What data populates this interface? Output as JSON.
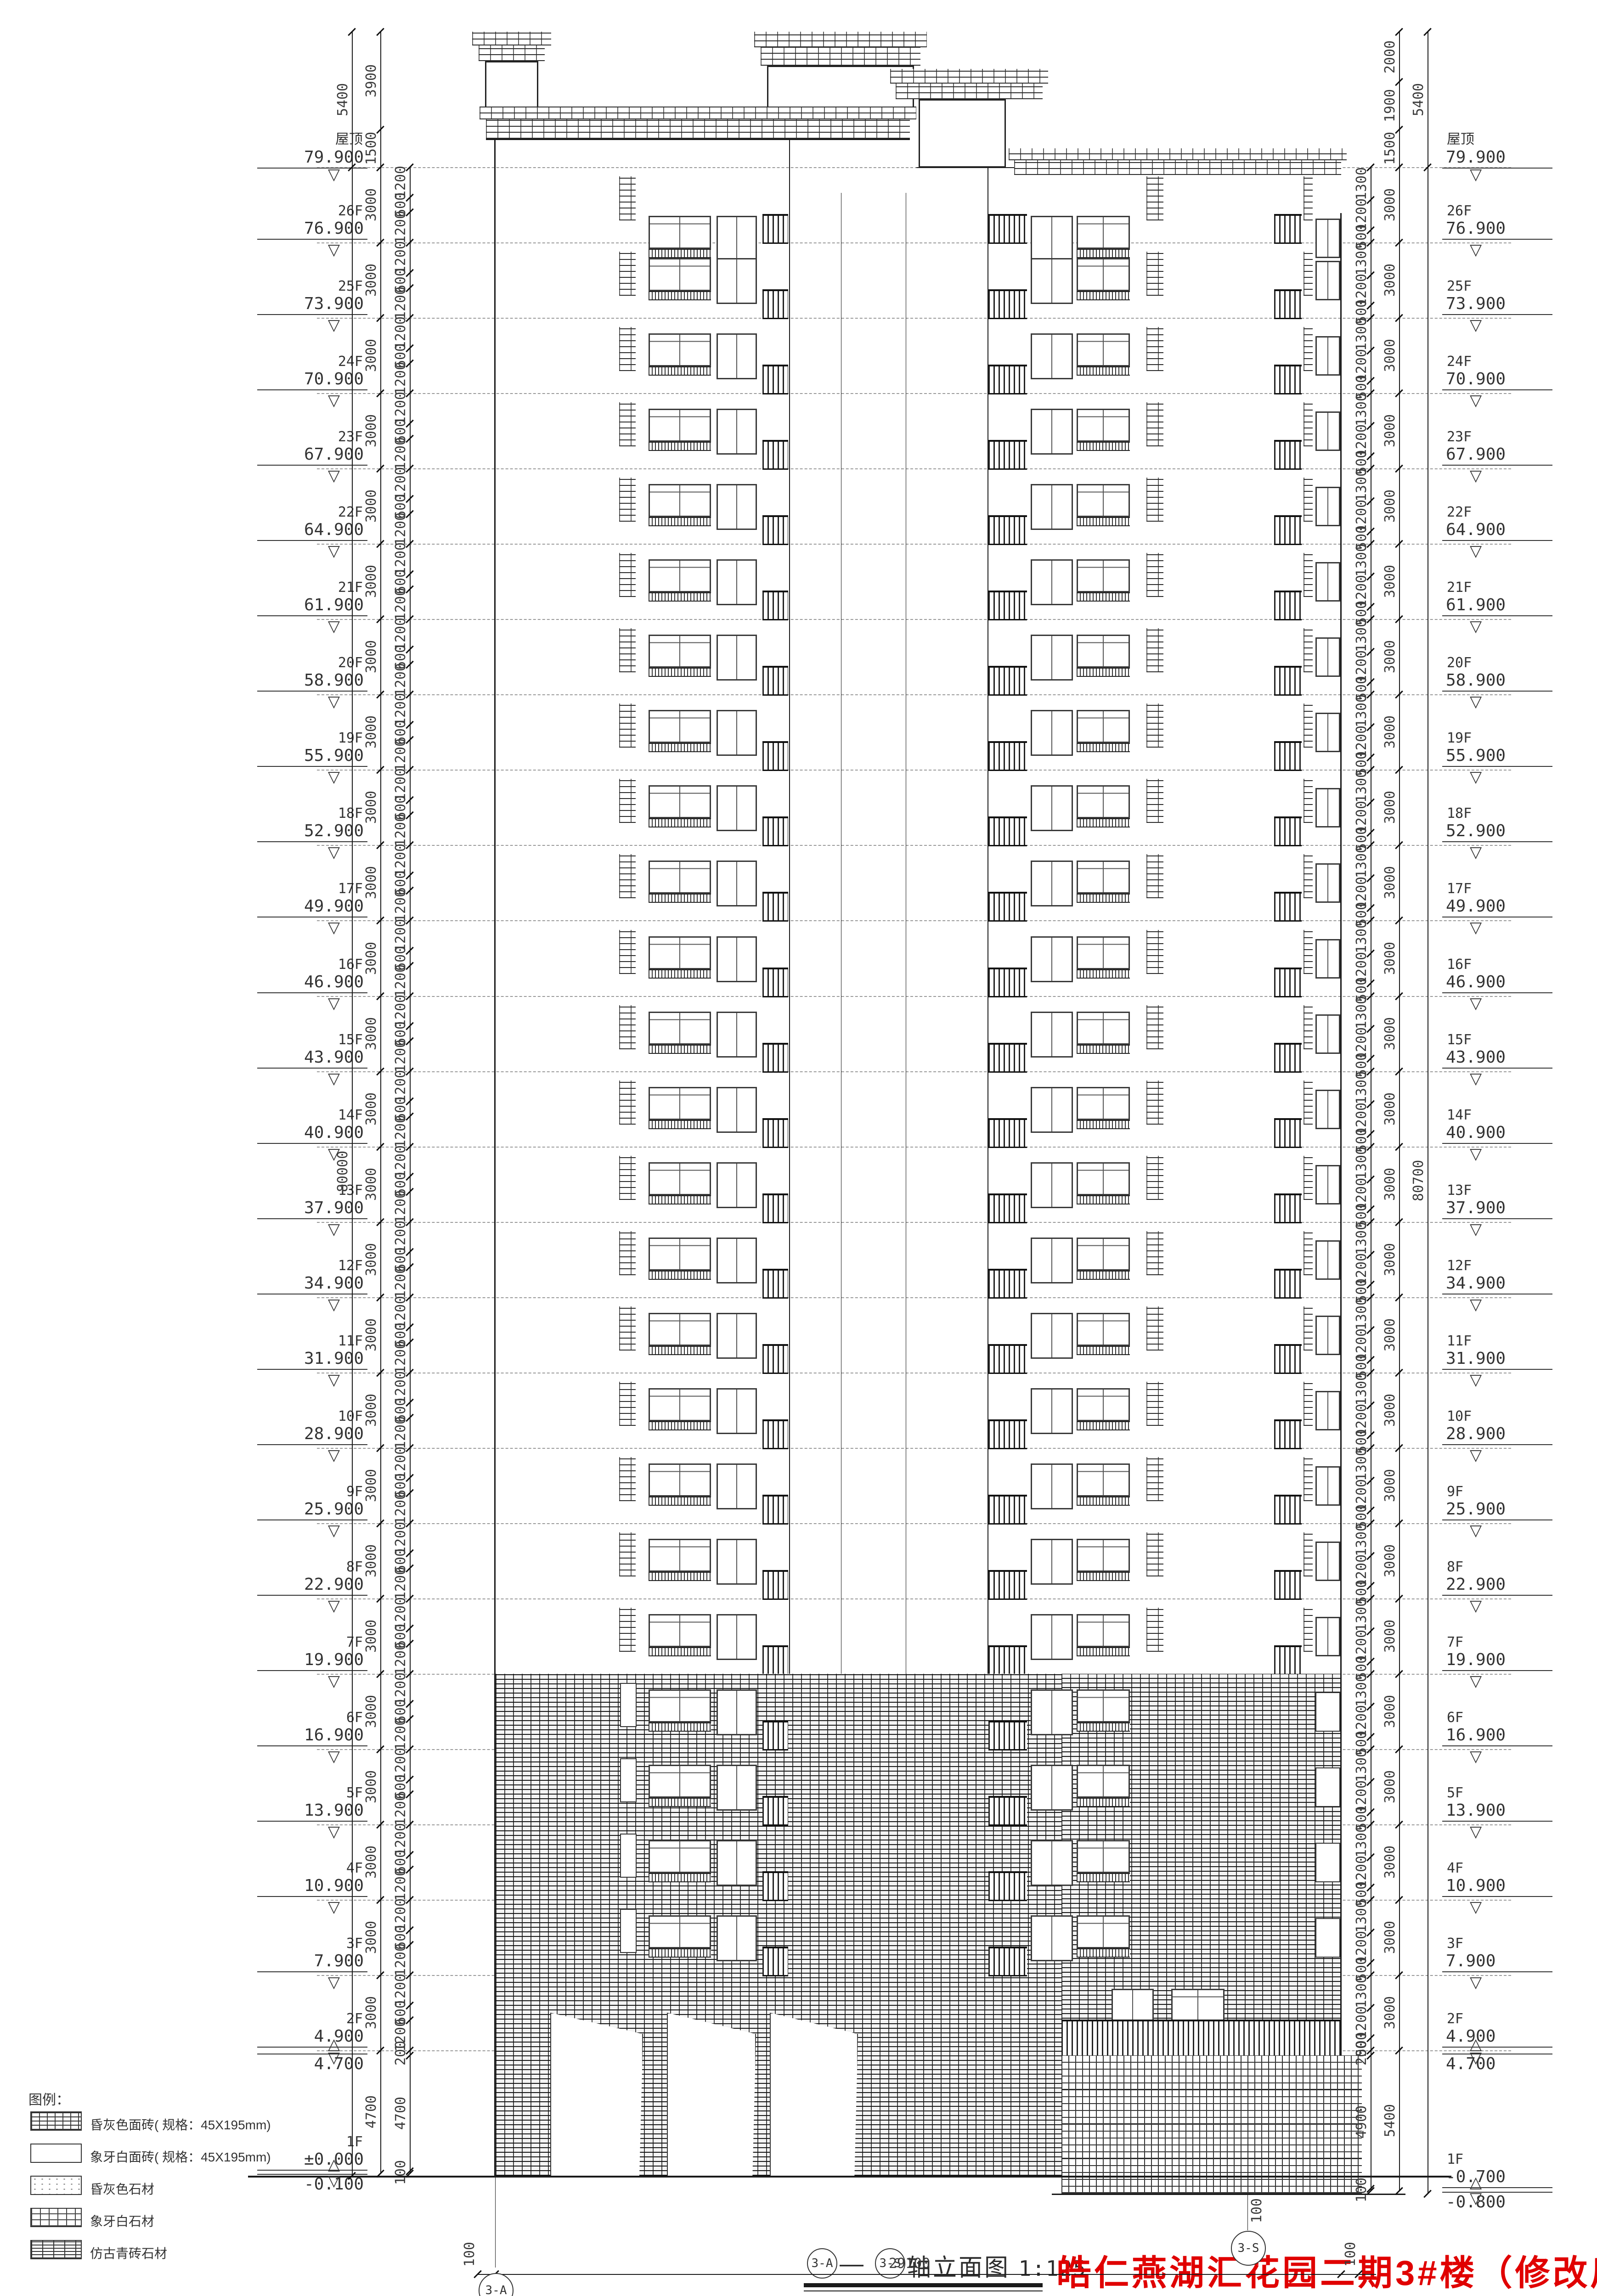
{
  "caption": {
    "axis_start": "3-A",
    "axis_end": "3-S",
    "dash": "—",
    "title": "轴立面图",
    "scale": "1:125"
  },
  "project": {
    "title": "皓仁燕湖汇花园二期3#楼（修改后）",
    "title_color": "#e00000"
  },
  "legend": {
    "heading": "图例：",
    "items": [
      {
        "label": "昏灰色面砖( 规格：45X195mm)",
        "swatch": "brick"
      },
      {
        "label": "象牙白面砖( 规格：45X195mm)",
        "swatch": "plain"
      },
      {
        "label": "昏灰色石材",
        "swatch": "dots"
      },
      {
        "label": "象牙白石材",
        "swatch": "grid"
      },
      {
        "label": "仿古青砖石材",
        "swatch": "dense"
      }
    ]
  },
  "levels": {
    "roof_label": "屋顶",
    "stories": [
      {
        "label": "屋顶",
        "elev": "79.900",
        "mm": 79900
      },
      {
        "label": "26F",
        "elev": "76.900",
        "mm": 76900
      },
      {
        "label": "25F",
        "elev": "73.900",
        "mm": 73900
      },
      {
        "label": "24F",
        "elev": "70.900",
        "mm": 70900
      },
      {
        "label": "23F",
        "elev": "67.900",
        "mm": 67900
      },
      {
        "label": "22F",
        "elev": "64.900",
        "mm": 64900
      },
      {
        "label": "21F",
        "elev": "61.900",
        "mm": 61900
      },
      {
        "label": "20F",
        "elev": "58.900",
        "mm": 58900
      },
      {
        "label": "19F",
        "elev": "55.900",
        "mm": 55900
      },
      {
        "label": "18F",
        "elev": "52.900",
        "mm": 52900
      },
      {
        "label": "17F",
        "elev": "49.900",
        "mm": 49900
      },
      {
        "label": "16F",
        "elev": "46.900",
        "mm": 46900
      },
      {
        "label": "15F",
        "elev": "43.900",
        "mm": 43900
      },
      {
        "label": "14F",
        "elev": "40.900",
        "mm": 40900
      },
      {
        "label": "13F",
        "elev": "37.900",
        "mm": 37900
      },
      {
        "label": "12F",
        "elev": "34.900",
        "mm": 34900
      },
      {
        "label": "11F",
        "elev": "31.900",
        "mm": 31900
      },
      {
        "label": "10F",
        "elev": "28.900",
        "mm": 28900
      },
      {
        "label": "9F",
        "elev": "25.900",
        "mm": 25900
      },
      {
        "label": "8F",
        "elev": "22.900",
        "mm": 22900
      },
      {
        "label": "7F",
        "elev": "19.900",
        "mm": 19900
      },
      {
        "label": "6F",
        "elev": "16.900",
        "mm": 16900
      },
      {
        "label": "5F",
        "elev": "13.900",
        "mm": 13900
      },
      {
        "label": "4F",
        "elev": "10.900",
        "mm": 10900
      },
      {
        "label": "3F",
        "elev": "7.900",
        "mm": 7900
      },
      {
        "label": "2F",
        "elev": "4.900",
        "mm": 4900
      }
    ],
    "left_extras": [
      {
        "label": "",
        "elev": "4.700",
        "mm": 4700,
        "minor": true
      },
      {
        "label": "1F",
        "elev": "±0.000",
        "mm": 0
      },
      {
        "label": "",
        "elev": "-0.100",
        "mm": -100,
        "minor": true
      }
    ],
    "right_extras": [
      {
        "label": "",
        "elev": "4.700",
        "mm": 4700,
        "minor": true
      },
      {
        "label": "1F",
        "elev": "-0.700",
        "mm": -700
      },
      {
        "label": "",
        "elev": "-0.800",
        "mm": -800,
        "minor": true
      }
    ]
  },
  "dims": {
    "story_dim": "3000",
    "left_total": "80000",
    "right_total": "80700",
    "top_outer": "5400",
    "left_top_chain": [
      {
        "label": "3900",
        "mm": 3900
      },
      {
        "label": "1500",
        "mm": 1500
      }
    ],
    "right_top_chain": [
      {
        "label": "2000",
        "mm": 2000
      },
      {
        "label": "1900",
        "mm": 1900
      },
      {
        "label": "1500",
        "mm": 1500
      }
    ],
    "left_story_chain": [
      {
        "label": "1200",
        "mm": 1200
      },
      {
        "label": "600",
        "mm": 600
      },
      {
        "label": "1200",
        "mm": 1200
      }
    ],
    "right_story_chain": [
      {
        "label": "1300",
        "mm": 1300
      },
      {
        "label": "1200",
        "mm": 1200
      },
      {
        "label": "500",
        "mm": 500
      }
    ],
    "left_bottom_chain": [
      {
        "label": "200",
        "mm": 200
      },
      {
        "label": "4700",
        "mm": 4600
      },
      {
        "label": "100",
        "mm": 100
      }
    ],
    "left_bottom_story": "4700",
    "right_bottom_chain": [
      {
        "label": "200",
        "mm": 200
      },
      {
        "label": "4900",
        "mm": 5300
      },
      {
        "label": "100",
        "mm": 100
      }
    ],
    "right_bottom_story": "5400",
    "bottom_chain": {
      "left_off": "100",
      "width": "29100",
      "right_off": "100"
    },
    "axis_offset": "100"
  },
  "axes": {
    "left_bubble": "3-A",
    "right_bubble": "3-S"
  }
}
